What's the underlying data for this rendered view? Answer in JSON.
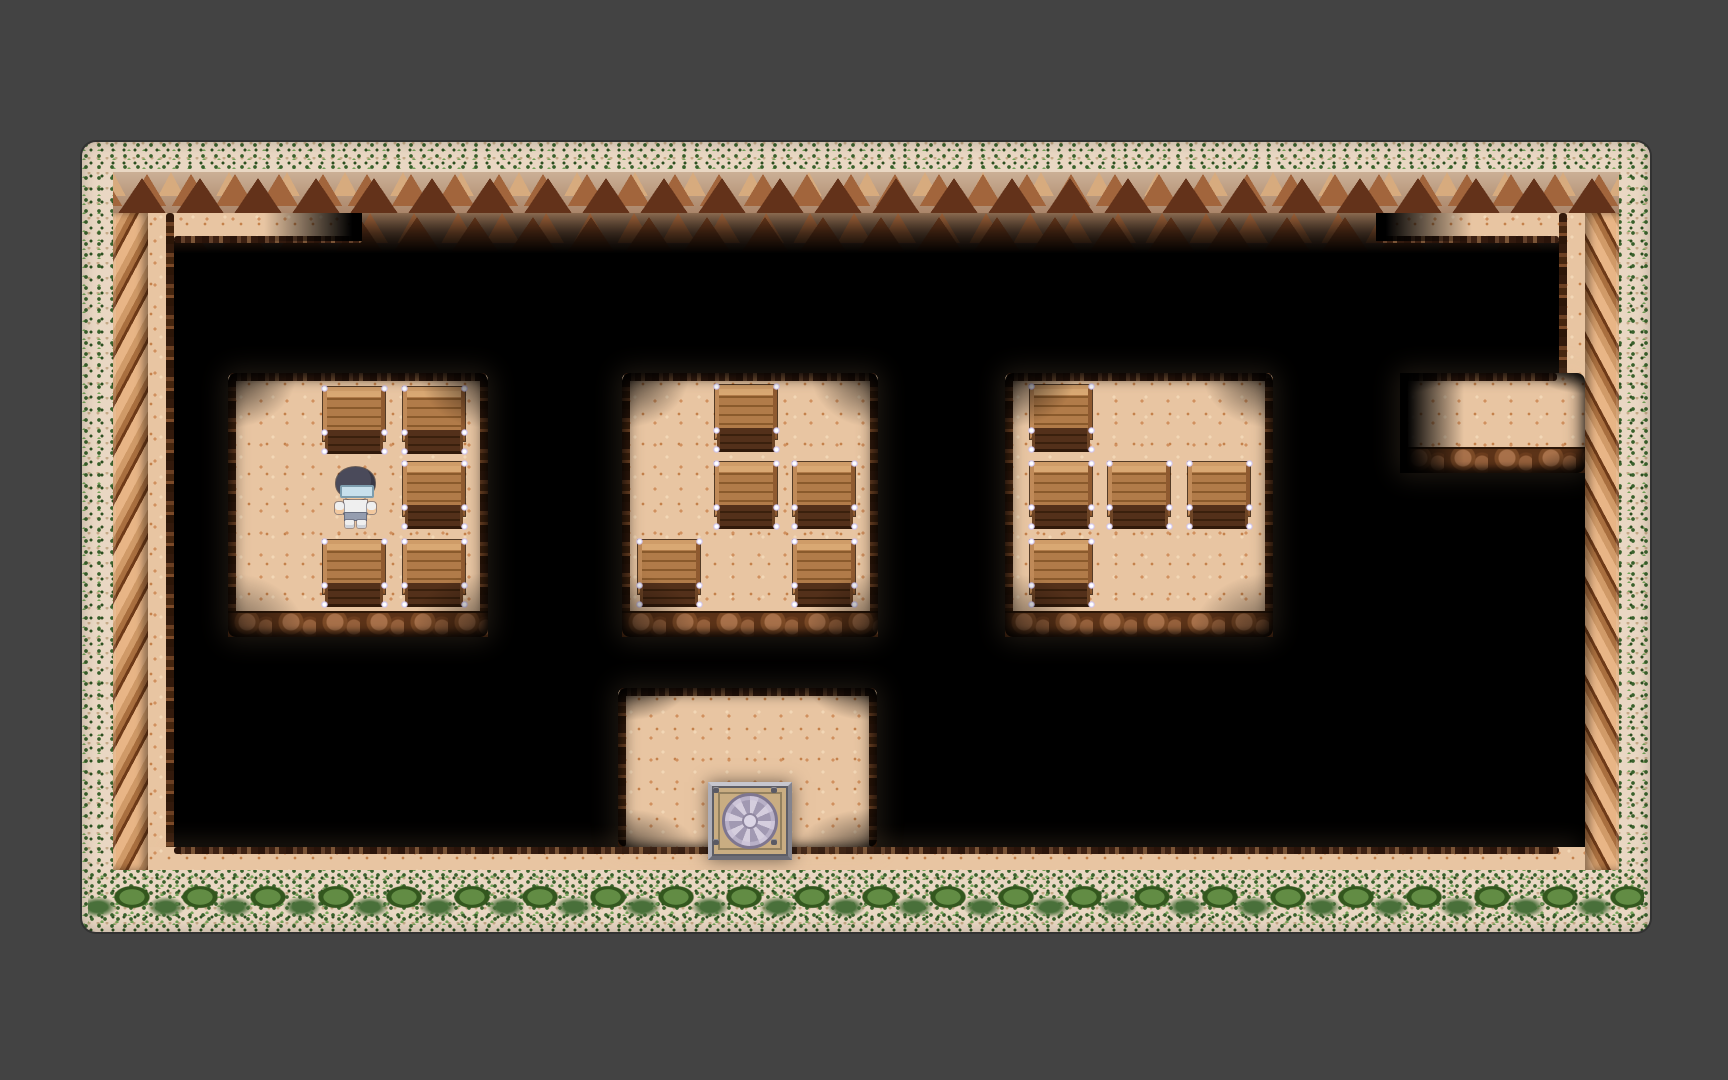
{
  "meta": {
    "scene": "top-down pixel-art RPG cave interior with fog of war, crate storage rooms, player sprite and a vault tile",
    "visible_text": "none"
  },
  "viewport": {
    "width": 1728,
    "height": 1080
  },
  "palette": {
    "bg": "#434343",
    "fog": "#000000",
    "floor": "#e8c5a2",
    "floor-speck": "#d0905e",
    "floor-speck2": "#c4814b",
    "floor-light": "#f2d7b6",
    "ivy-base": "#e9d7c3",
    "ivy-dark": "#39612c",
    "ivy-mid": "#2b4e1f",
    "ivy-light": "#74a258",
    "cliff-dark": "#63321a",
    "cliff-mid": "#a2653c",
    "cliff-light": "#d7ab7e",
    "crate-hl": "#d9a873",
    "sparkle": "#cfc3ee",
    "vault-face": "#c9ad82",
    "vault-petal-light": "#d5cede",
    "vault-petal-dark": "#a199b2",
    "player-hair": "#4a4a5a",
    "player-skin": "#f2c89e",
    "player-glasses": "#c8e0ec",
    "player-shirt": "#efefef",
    "player-shorts": "#959daf"
  },
  "frame": {
    "x": 82,
    "y": 142,
    "width": 1568,
    "height": 790,
    "ivy_top": 30,
    "ivy_side": 31,
    "ivy_bottom": 62,
    "cliff_height": 41,
    "wall_width": 35
  },
  "interior": {
    "x": 148,
    "y": 213,
    "width": 1437,
    "height": 657
  },
  "crate_size": {
    "w": 62,
    "h": 67
  },
  "paths": [
    {
      "id": "cliff-overhang-shadow",
      "kind": "cliff-lower",
      "x": 0,
      "y": 0,
      "w": 1437,
      "h": 44
    },
    {
      "id": "top-path-west",
      "kind": "floor",
      "x": 0,
      "y": 0,
      "w": 214,
      "h": 28,
      "edge_bottom": true,
      "edge_l": 26,
      "edge_r": 0,
      "fade": "right"
    },
    {
      "id": "top-path-east",
      "kind": "floor",
      "x": 1228,
      "y": 0,
      "w": 209,
      "h": 28,
      "edge_bottom": true,
      "edge_l": 0,
      "edge_r": 26,
      "fade": "left"
    },
    {
      "id": "west-wall-path",
      "kind": "floor",
      "x": 0,
      "y": 0,
      "w": 26,
      "h": 657,
      "rope": "right"
    },
    {
      "id": "east-wall-path",
      "kind": "floor",
      "x": 1411,
      "y": 0,
      "w": 26,
      "h": 172,
      "rope": "left"
    },
    {
      "id": "bottom-path",
      "kind": "floor",
      "x": 0,
      "y": 634,
      "w": 1437,
      "h": 23,
      "edge_top": true,
      "edge_l": 26,
      "edge_r": 26,
      "glow": true
    }
  ],
  "rooms": [
    {
      "id": "room-west",
      "x": 80,
      "y": 160,
      "w": 260,
      "h": 264,
      "ledge": true,
      "crates": [
        [
          175,
          174
        ],
        [
          255,
          174
        ],
        [
          255,
          249
        ],
        [
          175,
          327
        ],
        [
          255,
          327
        ]
      ]
    },
    {
      "id": "room-center",
      "x": 474,
      "y": 160,
      "w": 256,
      "h": 264,
      "ledge": true,
      "crates": [
        [
          567,
          172
        ],
        [
          567,
          249
        ],
        [
          645,
          249
        ],
        [
          490,
          327
        ],
        [
          645,
          327
        ]
      ]
    },
    {
      "id": "room-east",
      "x": 857,
      "y": 160,
      "w": 268,
      "h": 264,
      "ledge": true,
      "crates": [
        [
          882,
          172
        ],
        [
          882,
          249
        ],
        [
          960,
          249
        ],
        [
          1040,
          249
        ],
        [
          882,
          327
        ]
      ]
    },
    {
      "id": "room-vault",
      "x": 470,
      "y": 475,
      "w": 259,
      "h": 159,
      "ledge": false,
      "crates": []
    },
    {
      "id": "alcove-east",
      "x": 1252,
      "y": 160,
      "w": 185,
      "h": 100,
      "ledge": true,
      "rope_right": false,
      "edge_r": 28,
      "crates": []
    }
  ],
  "overlays": [
    {
      "id": "alcove-fog-west",
      "dir": "left",
      "x": 1252,
      "y": 160,
      "w": 64,
      "h": 100
    }
  ],
  "entities": {
    "player": {
      "id": "player-character",
      "x": 185,
      "y": 254,
      "w": 45,
      "h": 61,
      "room": "room-west",
      "facing": "down",
      "description": "boy sprite: dark bowl-cut hair, light blue glasses, white shirt, gray-blue shorts, white shoes"
    },
    "vault": {
      "id": "vault-chest",
      "x": 560,
      "y": 569,
      "w": 76,
      "h": 70,
      "room": "room-vault",
      "description": "square metal-framed vault tile with lavender rosette design and corner bolts"
    }
  },
  "counts": {
    "rooms": 5,
    "crates": 15,
    "players": 1,
    "vaults": 1
  }
}
